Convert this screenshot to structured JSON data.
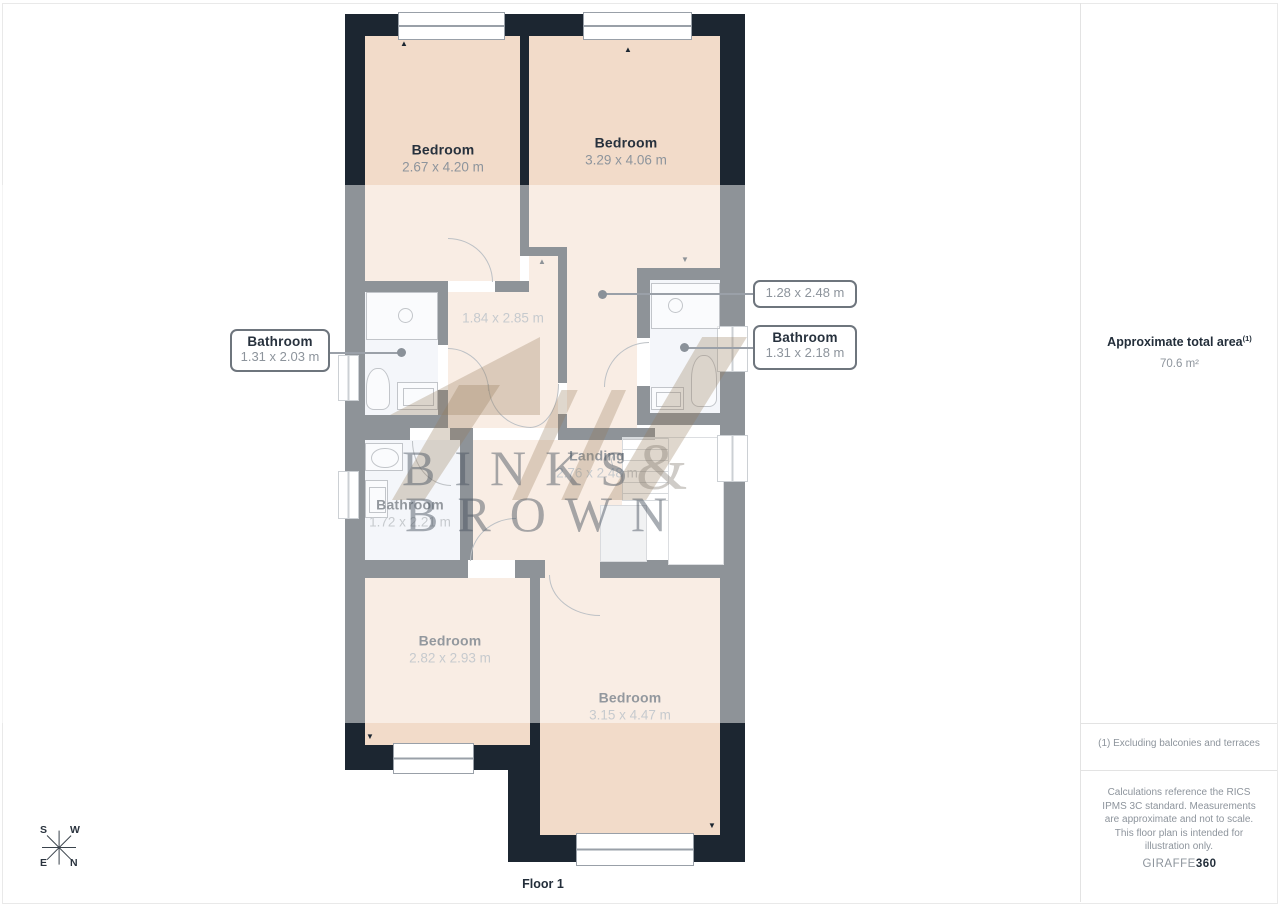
{
  "plan": {
    "floor_label": "Floor 1",
    "rooms": [
      {
        "id": "bedroom-top-left",
        "name": "Bedroom",
        "dims": "2.67 x 4.20 m"
      },
      {
        "id": "bedroom-top-right",
        "name": "Bedroom",
        "dims": "3.29 x 4.06 m"
      },
      {
        "id": "inner-hall",
        "name": "",
        "dims": "1.84 x 2.85 m"
      },
      {
        "id": "landing",
        "name": "Landing",
        "dims": "2.76 x 2.48 m"
      },
      {
        "id": "bathroom-middle",
        "name": "Bathroom",
        "dims": "1.72 x 2.21 m"
      },
      {
        "id": "bedroom-bottom-left",
        "name": "Bedroom",
        "dims": "2.82 x 2.93 m"
      },
      {
        "id": "bedroom-bottom-right",
        "name": "Bedroom",
        "dims": "3.15 x 4.47 m"
      }
    ],
    "callouts": [
      {
        "id": "bathroom-left-callout",
        "name": "Bathroom",
        "dims": "1.31 x 2.03 m"
      },
      {
        "id": "wc-right-callout",
        "name": "",
        "dims": "1.28 x 2.48 m"
      },
      {
        "id": "bathroom-right-callout",
        "name": "Bathroom",
        "dims": "1.31 x 2.18 m"
      }
    ],
    "compass": {
      "top_left": "S",
      "top_right": "W",
      "bottom_left": "E",
      "bottom_right": "N"
    }
  },
  "watermark": {
    "line1": "BINKS",
    "ampersand": "&",
    "line2": "BROWN"
  },
  "side_panel": {
    "area_title": "Approximate total area",
    "area_note_ref": "(1)",
    "area_value": "70.6 m²",
    "footnote": "(1) Excluding balconies and terraces",
    "disclaimer": "Calculations reference the RICS IPMS 3C standard. Measurements are approximate and not to scale. This floor plan is intended for illustration only.",
    "brand_prefix": "GIRAFFE",
    "brand_suffix": "360"
  },
  "colors": {
    "wall": "#1c2631",
    "floor_peach": "#f2dbc9",
    "floor_bathroom": "#e9edf4",
    "label_dark": "#27313d",
    "label_grey": "#8d949c",
    "watermark_grey": "#8f979e",
    "watermark_beige": "#cdbba6"
  }
}
